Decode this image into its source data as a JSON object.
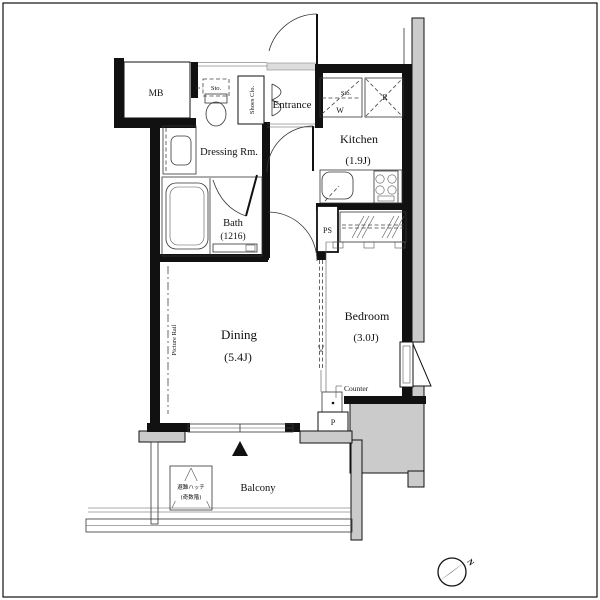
{
  "plan": {
    "rooms": {
      "entrance": {
        "label": "Entrance"
      },
      "kitchen": {
        "label": "Kitchen",
        "size": "(1.9J)"
      },
      "dressing_room": {
        "label": "Dressing Rm."
      },
      "bath": {
        "label": "Bath",
        "size": "(1216)"
      },
      "dining": {
        "label": "Dining",
        "size": "(5.4J)"
      },
      "bedroom": {
        "label": "Bedroom",
        "size": "(3.0J)"
      },
      "balcony": {
        "label": "Balcony"
      }
    },
    "labels": {
      "meter_box": "MB",
      "shoes_closet": "Shoes Clo.",
      "storage_above_toilet": "Sto.",
      "storage_kitchen_upper": "Sto.",
      "washer": "W",
      "refrigerator": "R",
      "storage_under_sink": "Sto.",
      "pipe_space": "PS",
      "picture_rail": "Picture Rail",
      "counter": "Counter",
      "pipe_shaft": "P",
      "evacuation_hatch_line1": "避難ハッチ",
      "evacuation_hatch_line2": "(奇数階)",
      "compass_north": "N"
    },
    "colors": {
      "wall": "#111111",
      "exterior_fill": "#cbcbcb",
      "line": "#333333",
      "background": "#ffffff"
    }
  }
}
